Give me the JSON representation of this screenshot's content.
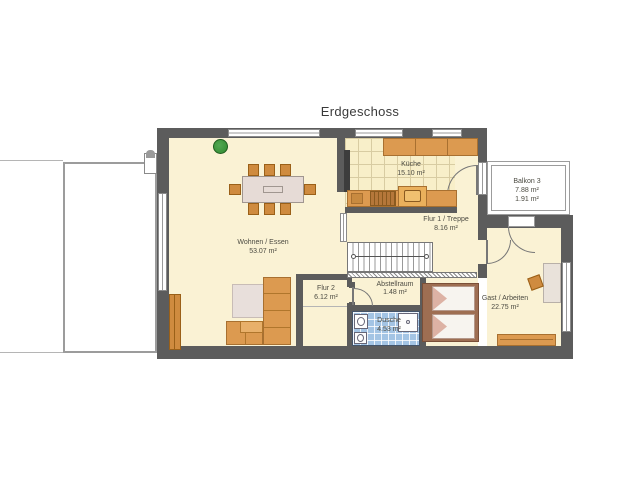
{
  "title": "Erdgeschoss",
  "rooms": {
    "wohnen": {
      "name": "Wohnen / Essen",
      "area": "53.07 m²"
    },
    "kueche": {
      "name": "Küche",
      "area": "15.10 m²"
    },
    "balkon": {
      "name": "Balkon 3",
      "area": "7.88 m²",
      "area2": "1.91 m²"
    },
    "flur1": {
      "name": "Flur 1 / Treppe",
      "area": "8.16 m²"
    },
    "flur2": {
      "name": "Flur 2",
      "area": "6.12 m²"
    },
    "abstellraum": {
      "name": "Abstellraum",
      "area": "1.48 m²"
    },
    "dusche": {
      "name": "Dusche",
      "area": "4.53 m²"
    },
    "gast": {
      "name": "Gast / Arbeiten",
      "area": "22.75 m²"
    }
  },
  "colors": {
    "wall": "#5c5c5c",
    "floor": "#faf2d4",
    "kitchen_tile": "#f8efc9",
    "shower_tile": "#a3c4e4",
    "furniture": "#dc9a50",
    "bed_frame": "#9e6e52",
    "plant": "#2f8a2f",
    "deck_border": "#9c9c9c"
  }
}
